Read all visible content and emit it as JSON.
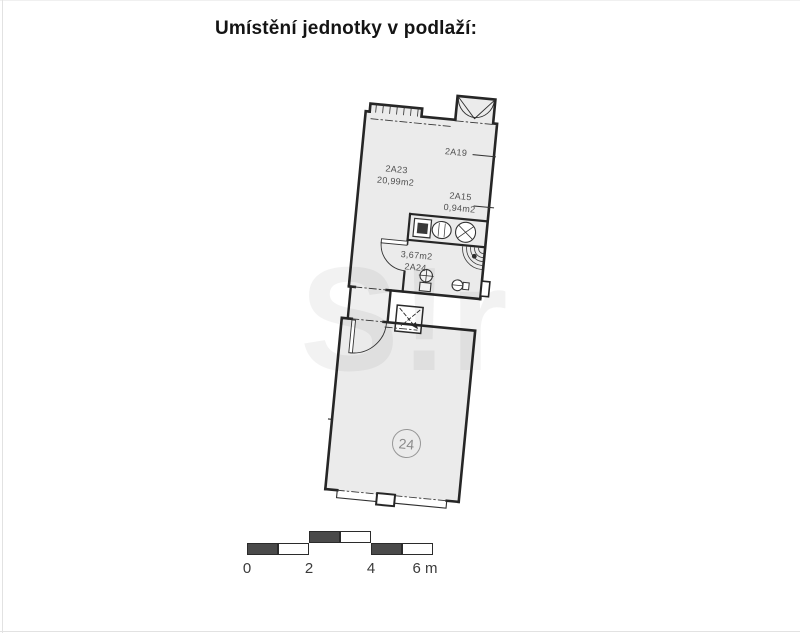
{
  "title": "Umístění jednotky v podlaží:",
  "floorplan": {
    "watermark": "S!r",
    "unit_circle": "24",
    "labels": {
      "main_room_id": "2A23",
      "main_room_area": "20,99m2",
      "side_room": "2A19",
      "niche_id": "2A15",
      "niche_area": "0,94m2",
      "bath_area": "3,67m2",
      "bath_id": "2A24"
    }
  },
  "scale_bar": {
    "tick_0": "0",
    "tick_2": "2",
    "tick_4": "4",
    "tick_6": "6 m"
  },
  "colors": {
    "wall": "#262626",
    "room_fill": "#ebebeb",
    "label_text": "#4f4f4f",
    "badge": "#8f8f8f",
    "scale_dark": "#4a4a4a",
    "title": "#141414"
  }
}
